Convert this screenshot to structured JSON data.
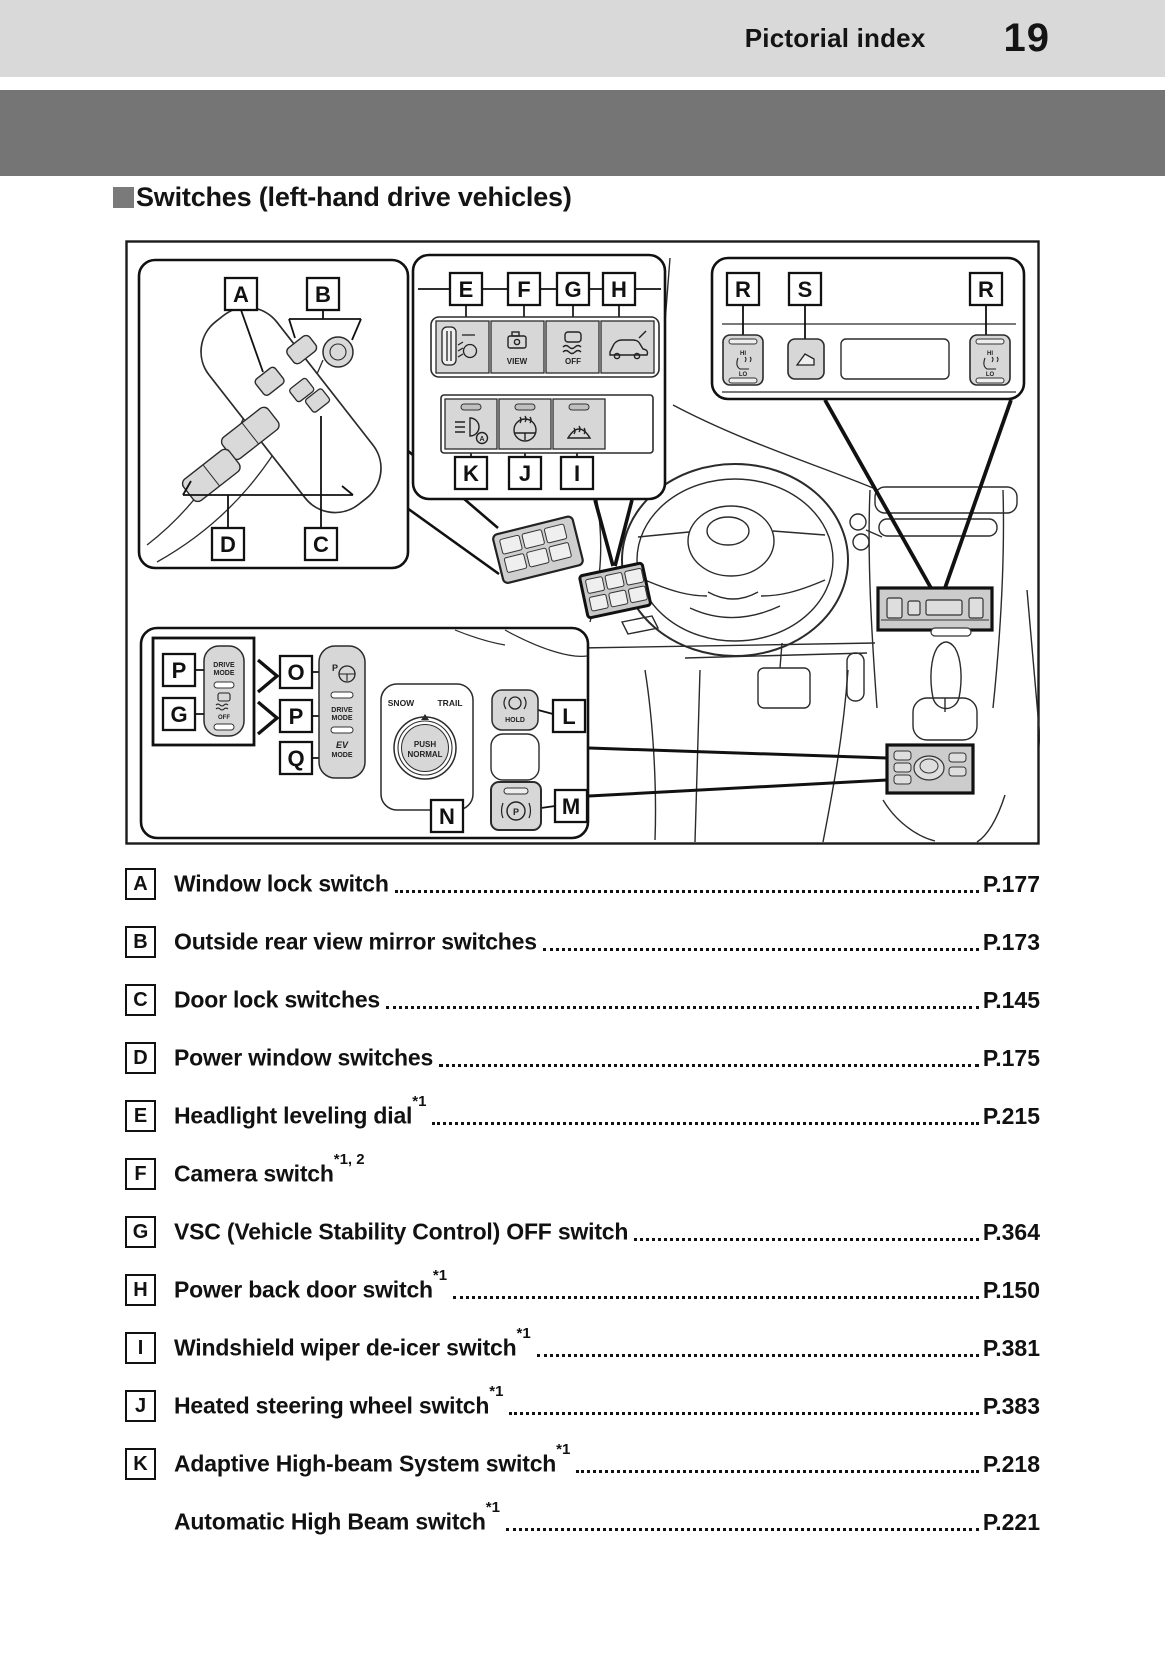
{
  "header": {
    "section": "Pictorial index",
    "page_number": "19"
  },
  "heading": {
    "label": "Switches (left-hand drive vehicles)"
  },
  "diagram": {
    "callout_letters": [
      "A",
      "B",
      "C",
      "D",
      "E",
      "F",
      "G",
      "H",
      "I",
      "J",
      "K",
      "L",
      "M",
      "N",
      "O",
      "P",
      "Q",
      "R",
      "S"
    ],
    "texts": {
      "view": "VIEW",
      "off": "OFF",
      "drive": "DRIVE",
      "mode": "MODE",
      "ev": "EV",
      "snow": "SNOW",
      "trail": "TRAIL",
      "push": "PUSH",
      "normal": "NORMAL",
      "hold": "HOLD",
      "hi": "HI",
      "lo": "LO",
      "p": "P",
      "a": "A"
    }
  },
  "index": {
    "items": [
      {
        "letter": "A",
        "label": "Window lock switch",
        "sup": "",
        "page": "P.177"
      },
      {
        "letter": "B",
        "label": "Outside rear view mirror switches ",
        "sup": "",
        "page": "P.173"
      },
      {
        "letter": "C",
        "label": "Door lock switches ",
        "sup": "",
        "page": "P.145"
      },
      {
        "letter": "D",
        "label": "Power window switches",
        "sup": "",
        "page": "P.175"
      },
      {
        "letter": "E",
        "label": "Headlight leveling dial",
        "sup": "*1",
        "page": "P.215"
      },
      {
        "letter": "F",
        "label": "Camera switch",
        "sup": "*1, 2",
        "page": ""
      },
      {
        "letter": "G",
        "label": "VSC (Vehicle Stability Control) OFF switch",
        "sup": "",
        "page": "P.364"
      },
      {
        "letter": "H",
        "label": "Power back door switch",
        "sup": "*1",
        "page": "P.150"
      },
      {
        "letter": "I",
        "label": "Windshield wiper de-icer switch",
        "sup": "*1",
        "page": "P.381"
      },
      {
        "letter": "J",
        "label": "Heated steering wheel switch",
        "sup": "*1",
        "page": "P.383"
      },
      {
        "letter": "K",
        "label": "Adaptive High-beam System switch",
        "sup": "*1",
        "page": "P.218"
      },
      {
        "letter": "",
        "label": "Automatic High Beam switch",
        "sup": "*1",
        "page": "P.221"
      }
    ]
  }
}
